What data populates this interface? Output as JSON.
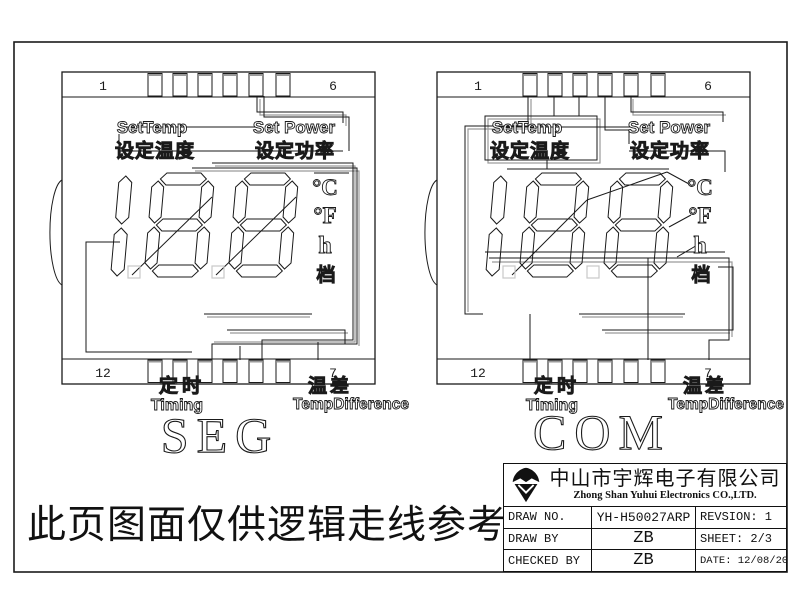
{
  "colors": {
    "line": "#1a1a1a",
    "gray": "#9a9a9a",
    "light": "#c8c8c8",
    "bg": "#ffffff"
  },
  "panels": [
    {
      "caption": "SEG",
      "pin_top_left": "1",
      "pin_top_right": "6",
      "pin_bottom_left": "12",
      "pin_bottom_right": "7"
    },
    {
      "caption": "COM",
      "pin_top_left": "1",
      "pin_top_right": "6",
      "pin_bottom_left": "12",
      "pin_bottom_right": "7"
    }
  ],
  "panel_labels": {
    "set_temp_en": "SetTemp",
    "set_temp_cn": "设定温度",
    "set_power_en": "Set Power",
    "set_power_cn": "设定功率",
    "timing_cn": "定时",
    "timing_en": "Timing",
    "temp_diff_cn": "温差",
    "temp_diff_en": "TempDifference",
    "celsius": "°C",
    "fahrenheit": "°F",
    "hour": "h",
    "gear": "档"
  },
  "note": "此页图面仅供逻辑走线参考",
  "title_block": {
    "company_cn": "中山市宇辉电子有限公司",
    "company_en": "Zhong Shan Yuhui Electronics CO.,LTD.",
    "rows": [
      {
        "label": "DRAW NO.",
        "value": "YH-H50027ARP",
        "right": "REVSION:  1"
      },
      {
        "label": "DRAW BY",
        "value": "ZB",
        "right": "SHEET: 2/3"
      },
      {
        "label": "CHECKED BY",
        "value": "ZB",
        "right": "DATE: 12/08/2020"
      }
    ]
  }
}
